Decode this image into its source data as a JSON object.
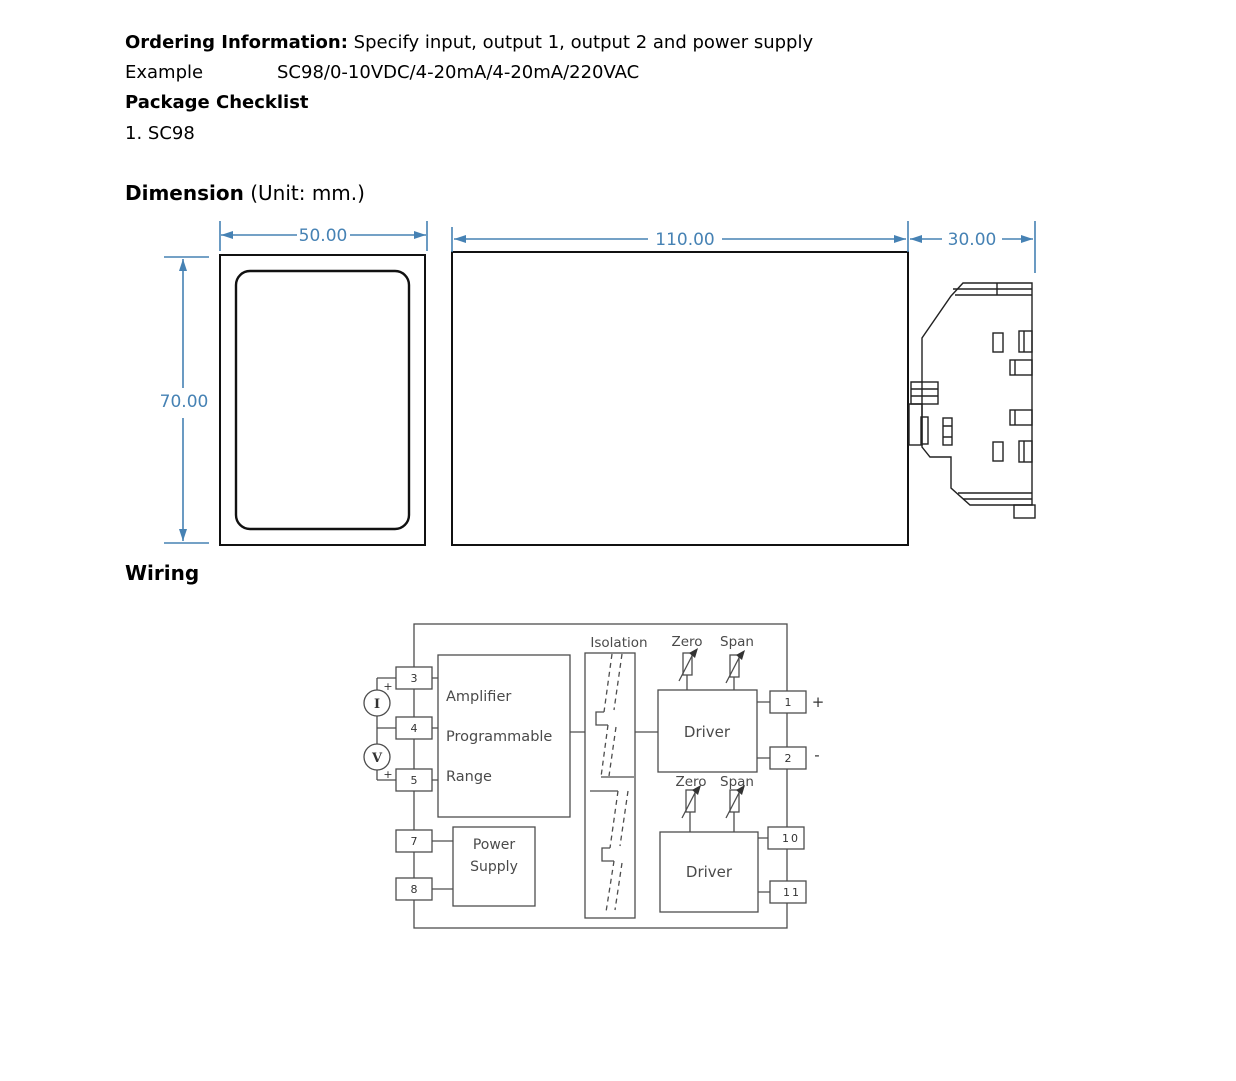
{
  "header": {
    "ordering_label": "Ordering Information:",
    "ordering_text": " Specify input, output 1, output 2 and power supply",
    "example_label": "Example",
    "example_value": "SC98/0-10VDC/4-20mA/4-20mA/220VAC",
    "package_heading": "Package Checklist",
    "package_item": "1. SC98"
  },
  "dimension": {
    "heading": "Dimension",
    "heading_unit": " (Unit: mm.)",
    "front_width": "50.00",
    "front_height": "70.00",
    "body_length": "110.00",
    "side_depth": "30.00",
    "accent_color": "#4682b4",
    "line_color": "#111111"
  },
  "wiring": {
    "heading": "Wiring",
    "line_color": "#4d4d4d",
    "amplifier_line1": "Amplifier",
    "amplifier_line2": "Programmable",
    "amplifier_line3": "Range",
    "power_line1": "Power",
    "power_line2": "Supply",
    "isolation_label": "Isolation",
    "driver1_label": "Driver",
    "driver2_label": "Driver",
    "zero1": "Zero",
    "span1": "Span",
    "zero2": "Zero",
    "span2": "Span",
    "current_source": "I",
    "voltage_source": "V",
    "input_plus_top": "+",
    "input_plus_bottom": "+",
    "output1_polarity": "+",
    "output2_polarity": "-",
    "terminal_3": "3",
    "terminal_4": "4",
    "terminal_5": "5",
    "terminal_7": "7",
    "terminal_8": "8",
    "terminal_1": "1",
    "terminal_2": "2",
    "terminal_10": "10",
    "terminal_11": "11"
  }
}
